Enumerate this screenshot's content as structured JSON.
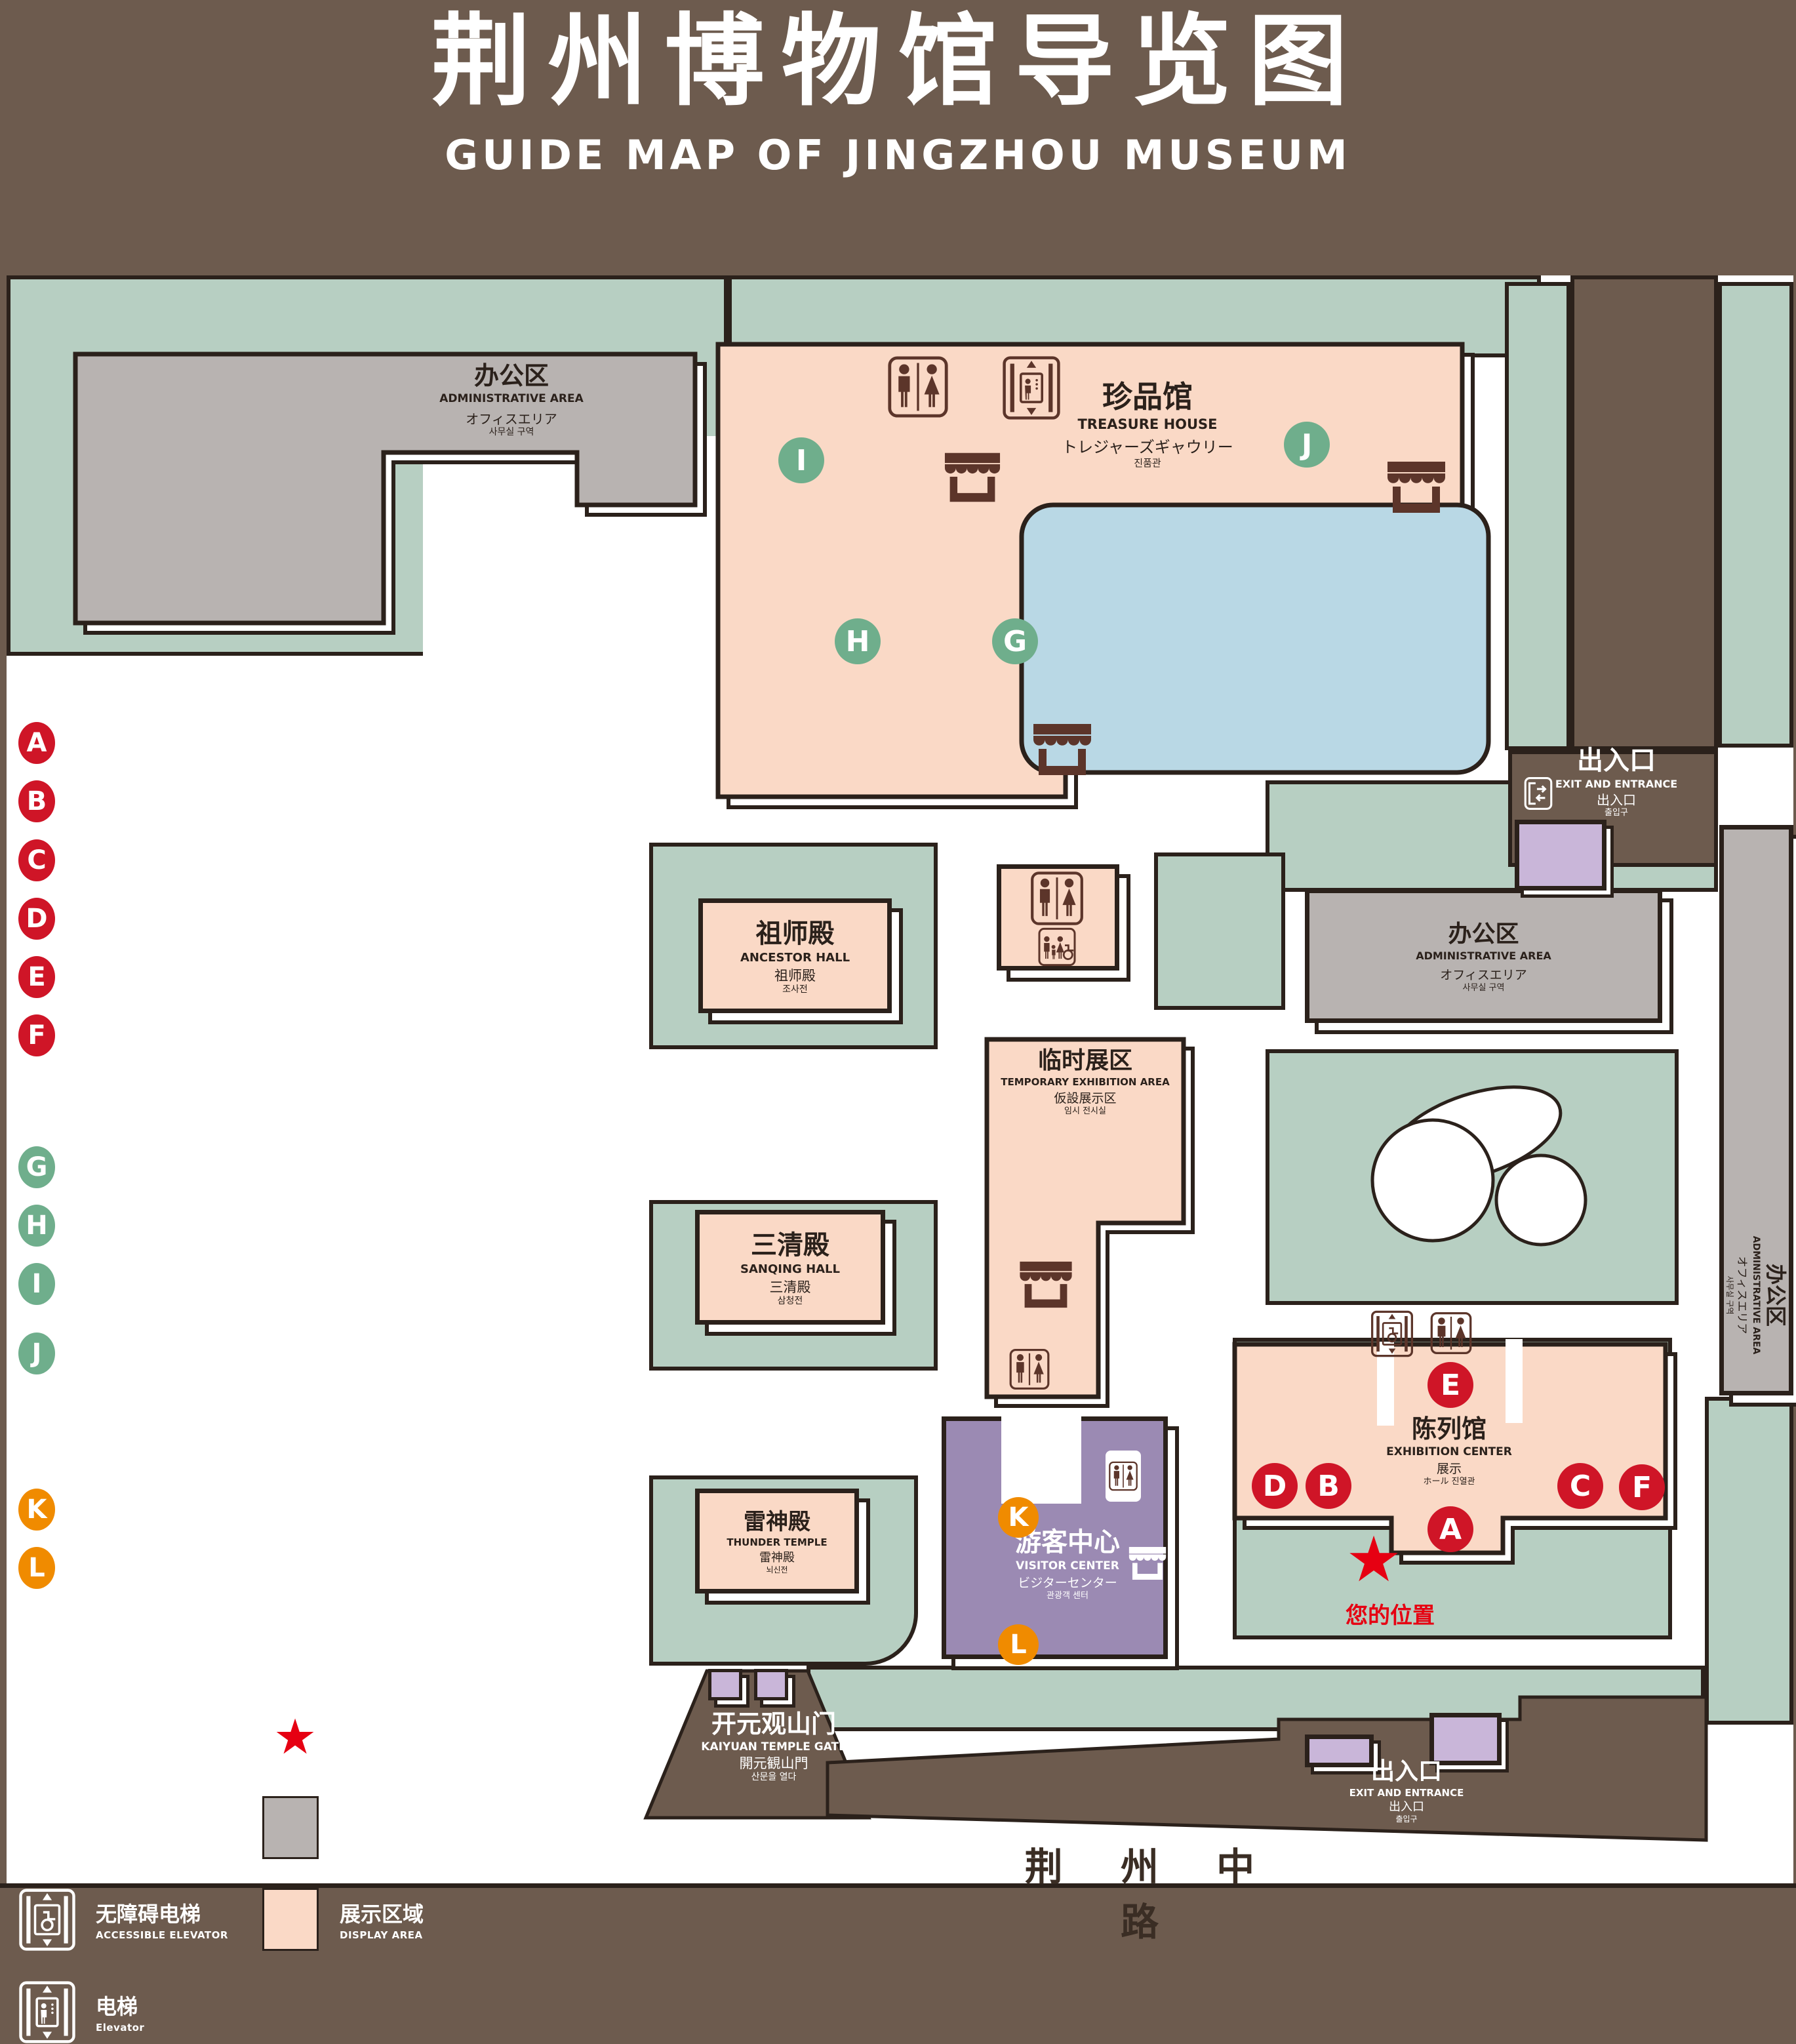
{
  "title": {
    "zh": "荆州博物馆导览图",
    "en": "GUIDE MAP OF JINGZHOU MUSEUM"
  },
  "legend": {
    "sections": [
      {
        "zh": "陈列馆",
        "en": "EXHIBITION CENTER",
        "items": [
          {
            "key": "A",
            "zh": "《火中的凤凰》壁画",
            "en": "THE PHOENIX IN FIRE \"MURAL PAINTING",
            "floor": "1F"
          },
          {
            "key": "B",
            "zh": "荆州出土铜器展",
            "en": "JINGZHOU UNEARTHED BRONZE WARE EXHIBITION",
            "floor": "1F"
          },
          {
            "key": "C",
            "zh": "江汉平原原始文化展",
            "en": "JIANGHAN PLAIN PRIMITIVE CULTURE EXHIBITION",
            "floor": "1F"
          },
          {
            "key": "D",
            "zh": "荆州出土瓷器展",
            "en": "JINGZHOU UNEARTHED PORCELAIN EXHIBITIONE",
            "floor": "2F"
          },
          {
            "key": "E",
            "zh": "荆州出土简牍展",
            "en": "JINGZHOU EXCAVATED BAMBOO SLIPS EXHIBITION",
            "floor": "2F"
          },
          {
            "key": "F",
            "zh": "荆州出土玉器展",
            "en": "JINGZHOU UNEARTHED JADE EXHIBITION",
            "floor": "2F"
          }
        ]
      },
      {
        "zh": "珍品馆",
        "en": "TREASURE HOUSE",
        "items": [
          {
            "key": "G",
            "zh": "放映厅",
            "en": "PROJECTION HALL",
            "floor": "1F"
          },
          {
            "key": "H",
            "zh": "互动体验厅",
            "en": "INTERACTIVE EXPERIENCE HALL",
            "floor": "1F"
          },
          {
            "key": "I",
            "zh": "五大夫遂——凤凰山168号汉墓展",
            "en": "WUDAFU—EXHIBITION OF NO.168 HAN TOMB FROM FENGHUANGSHAN",
            "floor": "2F"
          },
          {
            "key": "J",
            "zh": "丹漆神韵——楚秦汉漆器精品展",
            "en": "ROMANTIC CHARM OF THE CRIMSON LACQUERS—EXHIBITIONS OF FINE LACQUERS FROM CHU,QIN AND HAN DYNASTIES",
            "floor": "1-2F"
          }
        ]
      },
      {
        "zh": "游客中心",
        "en": "VISITOR CENTER",
        "items": [
          {
            "key": "K",
            "zh": "安全保卫",
            "en": "SECURITY",
            "floor": "1F"
          },
          {
            "key": "L",
            "zh": "医疗点",
            "en": "CLINIC",
            "floor": "1F"
          }
        ]
      }
    ],
    "icon_items": [
      {
        "icon": "store-icon",
        "zh": "文创商店",
        "en": "STORE"
      },
      {
        "icon": "exit-entrance-icon",
        "zh": "出入口",
        "en": "EXIT AND ENTRANCE"
      },
      {
        "icon": "restrooms-icon",
        "zh": "卫生间",
        "en": "RESTROOMS"
      },
      {
        "icon": "your-location-star-icon",
        "zh": "您的位置",
        "en": "YOUR LOCATION"
      },
      {
        "icon": "family-restrooms-icon",
        "zh": "家庭卫生间",
        "en": "FAMILY RESTROOMS"
      },
      {
        "icon": "office-area-swatch",
        "zh": "办公区域",
        "en": "OFFICE AREA"
      },
      {
        "icon": "accessible-elevator-icon",
        "zh": "无障碍电梯",
        "en": "ACCESSIBLE ELEVATOR"
      },
      {
        "icon": "display-area-swatch",
        "zh": "展示区域",
        "en": "DISPLAY AREA"
      },
      {
        "icon": "elevator-icon",
        "zh": "电梯",
        "en": "Elevator"
      }
    ]
  },
  "map": {
    "buildings": {
      "admin": {
        "zh": "办公区",
        "en": "ADMINISTRATIVE AREA",
        "jp": "オフィスエリア",
        "kr": "사무실 구역"
      },
      "treasure_house": {
        "zh": "珍品馆",
        "en": "TREASURE HOUSE",
        "jp": "トレジャーズギャウリー",
        "kr": "진품관"
      },
      "ancestor_hall": {
        "zh": "祖师殿",
        "en": "ANCESTOR HALL",
        "jp": "祖师殿",
        "kr": "조사전"
      },
      "temporary_area": {
        "zh": "临时展区",
        "en": "TEMPORARY EXHIBITION AREA",
        "jp": "仮設展示区",
        "kr": "임시 전시실"
      },
      "sanqing_hall": {
        "zh": "三清殿",
        "en": "SANQING HALL",
        "jp": "三清殿",
        "kr": "삼청전"
      },
      "thunder_temple": {
        "zh": "雷神殿",
        "en": "THUNDER TEMPLE",
        "jp": "雷神殿",
        "kr": "뇌신전"
      },
      "visitor_center": {
        "zh": "游客中心",
        "en": "VISITOR CENTER",
        "jp": "ビジターセンター",
        "kr": "관광객 센터"
      },
      "exhibition_center": {
        "zh": "陈列馆",
        "en": "EXHIBITION CENTER",
        "jp": "展示",
        "kr": "ホール 진열관"
      }
    },
    "exit_north": {
      "zh": "出入口",
      "en": "EXIT AND ENTRANCE",
      "jp": "出入口",
      "kr": "출입구"
    },
    "exit_south": {
      "zh": "出入口",
      "en": "EXIT AND ENTRANCE",
      "jp": "出入口",
      "kr": "출입구"
    },
    "gate": {
      "zh": "开元观山门",
      "en": "KAIYUAN TEMPLE GATE",
      "jp": "開元観山門",
      "kr": "산문을 열다"
    },
    "road": "荆 州 中 路",
    "your_location": "您的位置",
    "your_location_star": "★",
    "marker_letters": {
      "A": "A",
      "B": "B",
      "C": "C",
      "D": "D",
      "E": "E",
      "F": "F",
      "G": "G",
      "H": "H",
      "I": "I",
      "J": "J",
      "K": "K",
      "L": "L"
    }
  },
  "colors": {
    "background": "#6d5b4e",
    "lawn": "#b7cfc2",
    "display_area": "#fad9c6",
    "office_area": "#b8b3b1",
    "visitor_center": "#9b8ab3",
    "water": "#b9d8e5",
    "marker_red": "#cf1527",
    "marker_green": "#6fae8c",
    "marker_orange": "#f08b00",
    "location_red": "#e60012",
    "outline": "#2b211b",
    "icon_brown": "#5c352a"
  }
}
